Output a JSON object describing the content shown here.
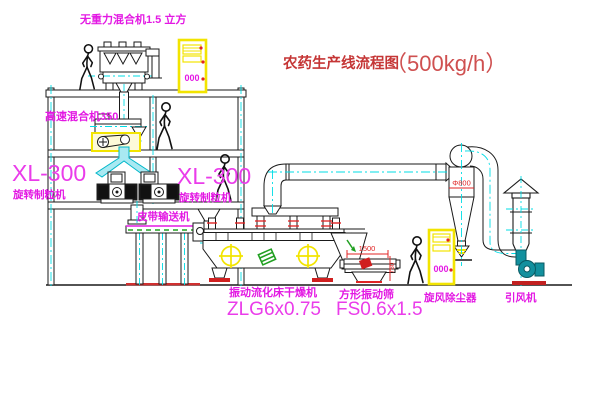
{
  "title": {
    "name": "农药生产线流程图",
    "capacity": "（500kg/h）"
  },
  "labels": {
    "gravity_mixer": "无重力混合机1.5 立方",
    "high_speed_mixer": "高速混合机350",
    "granulator_left_model": "XL-300",
    "granulator_left_name": "旋转制粒机",
    "granulator_right_model": "XL-300",
    "granulator_right_name": "旋转制粒机",
    "belt_conveyor": "皮带输送机",
    "dryer_name": "振动流化床干燥机",
    "dryer_model": "ZLG6x0.75",
    "screen_name": "方形振动筛",
    "screen_model": "FS0.6x1.5",
    "cyclone_name": "旋风除尘器",
    "fan_name": "引风机"
  },
  "dimensions": {
    "screen_width": "1500",
    "screen_height": "750",
    "cyclone_diameter": "Φ800"
  },
  "cabinets": {
    "control_panel_top": "000",
    "control_panel_right": "000"
  },
  "colors": {
    "line_black": "#1a1a1a",
    "centerline_cyan": "#00dde6",
    "label_magenta": "#e318e3",
    "title_red": "#c53636",
    "highlight_yellow": "#f2e400",
    "dimension_red": "#e02424",
    "chute_cyan": "#a9e9f2",
    "fan_teal": "#12909e",
    "conveyor_green": "#22a022"
  }
}
